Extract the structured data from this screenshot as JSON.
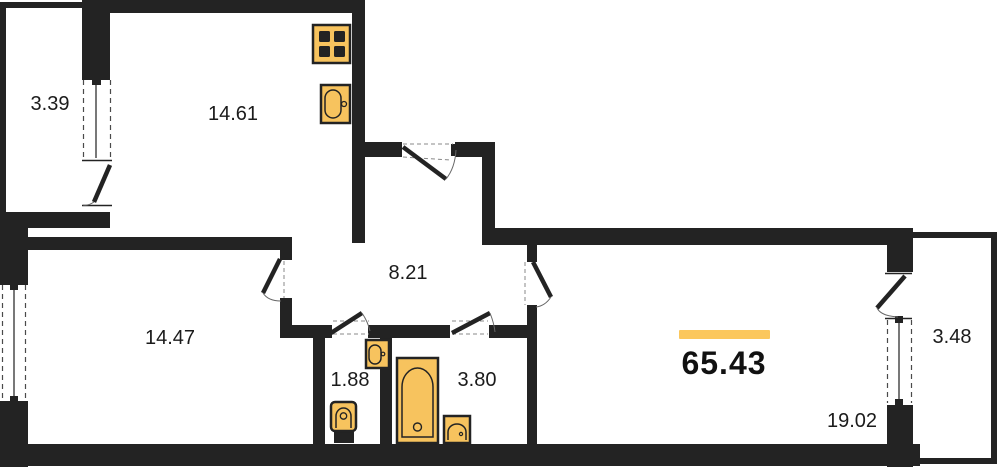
{
  "floor_plan": {
    "type": "apartment-floor-plan",
    "total_area": "65.43",
    "rooms": [
      {
        "name": "balcony-left",
        "area": "3.39"
      },
      {
        "name": "kitchen",
        "area": "14.61"
      },
      {
        "name": "hallway",
        "area": "8.21"
      },
      {
        "name": "bedroom",
        "area": "14.47"
      },
      {
        "name": "wc",
        "area": "1.88"
      },
      {
        "name": "bathroom",
        "area": "3.80"
      },
      {
        "name": "living-room",
        "area": "19.02"
      },
      {
        "name": "balcony-right",
        "area": "3.48"
      }
    ],
    "fixtures": [
      "stove",
      "kitchen-sink",
      "washbasin",
      "toilet",
      "bathtub",
      "basin"
    ],
    "colors": {
      "wall": "#232323",
      "fixture_fill": "#F7C35E",
      "accent_bar": "#FBC75D",
      "background": "#FFFFFF"
    }
  }
}
